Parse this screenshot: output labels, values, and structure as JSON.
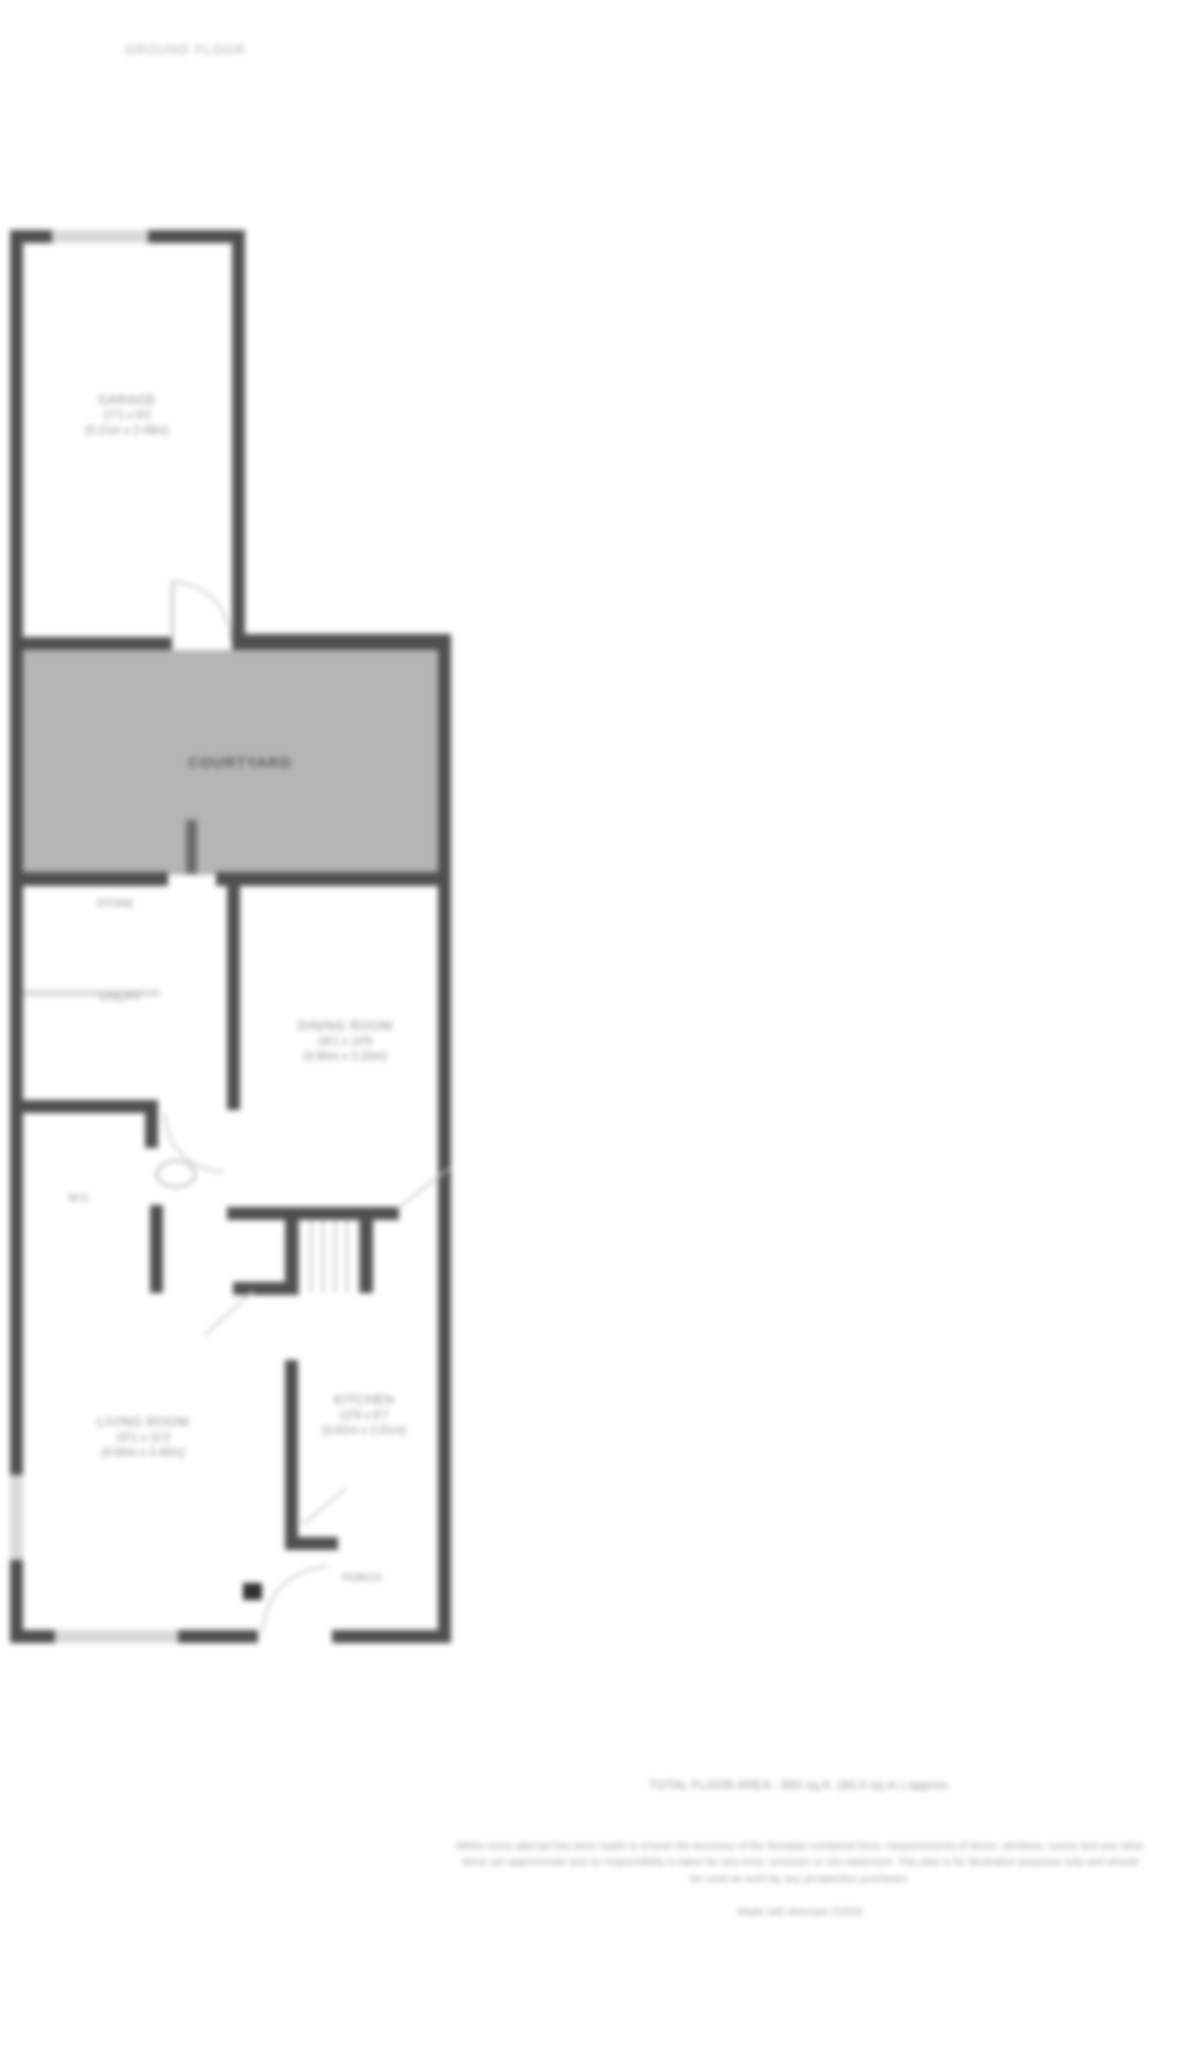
{
  "page_title": "GROUND FLOOR",
  "floorplan": {
    "courtyard": {
      "label": "COURTYARD"
    },
    "rooms": {
      "garage": {
        "name": "GARAGE",
        "dims_imperial": "17'1 x 8'2",
        "dims_metric": "(5.21m x 2.49m)"
      },
      "dining": {
        "name": "DINING ROOM",
        "dims_imperial": "16'1 x 10'6",
        "dims_metric": "(4.90m x 3.20m)"
      },
      "living": {
        "name": "LIVING ROOM",
        "dims_imperial": "15'1 x 11'2",
        "dims_metric": "(4.60m x 3.40m)"
      },
      "kitchen": {
        "name": "KITCHEN",
        "dims_imperial": "12'6 x 6'7",
        "dims_metric": "(3.81m x 2.01m)"
      }
    },
    "small_labels": {
      "store": "STORE",
      "utility": "UTILITY",
      "wc": "W.C.",
      "porch": "PORCH"
    }
  },
  "footer": {
    "area_line": "TOTAL FLOOR AREA : 893 sq.ft. (83.0 sq.m.) approx.",
    "disclaimer": "Whilst every attempt has been made to ensure the accuracy of the floorplan contained here, measurements of doors, windows, rooms and any other items are approximate and no responsibility is taken for any error, omission or mis-statement. This plan is for illustrative purposes only and should be used as such by any prospective purchaser.",
    "credit": "Made with Metropix ©2023"
  },
  "colors": {
    "wall": "#4f4f4f",
    "courtyard_fill": "#b5b5b5",
    "window": "#d8d8d8",
    "label_text": "#8a8a8a"
  }
}
